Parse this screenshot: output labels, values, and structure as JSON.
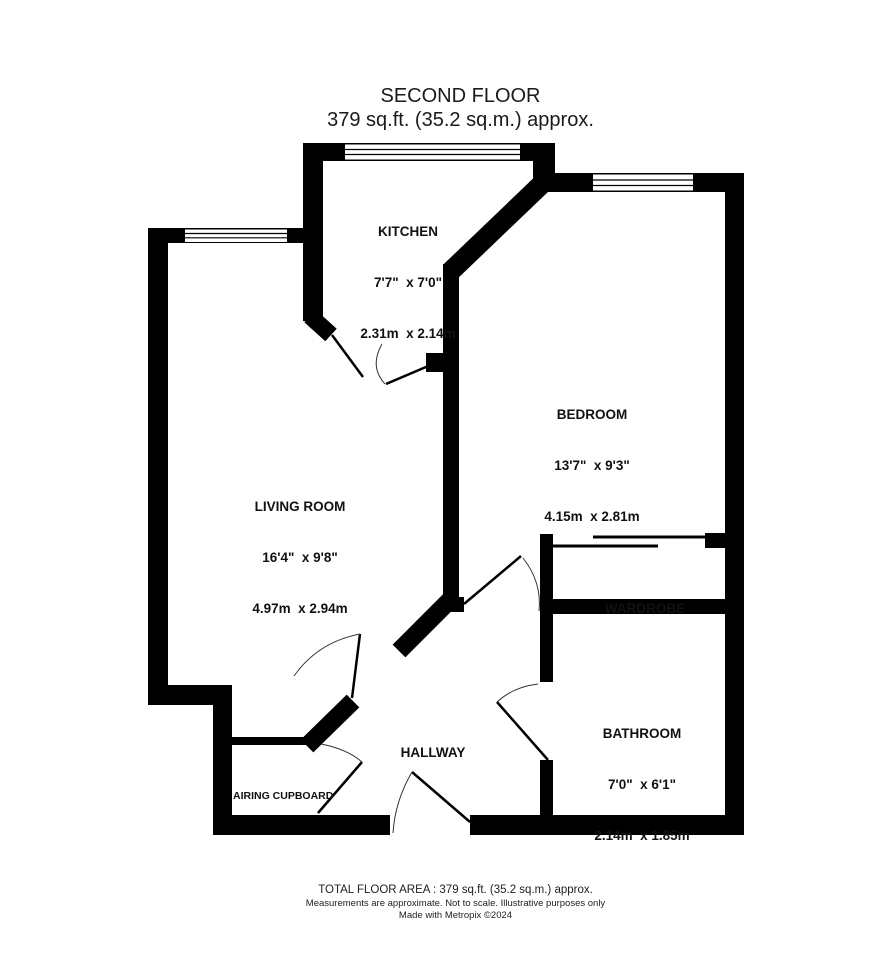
{
  "title": {
    "line1": "SECOND FLOOR",
    "line2": "379 sq.ft. (35.2 sq.m.) approx."
  },
  "rooms": [
    {
      "id": "kitchen",
      "name": "KITCHEN",
      "imperial": "7'7\"  x 7'0\"",
      "metric": "2.31m  x 2.14m"
    },
    {
      "id": "bedroom",
      "name": "BEDROOM",
      "imperial": "13'7\"  x 9'3\"",
      "metric": "4.15m  x 2.81m"
    },
    {
      "id": "living-room",
      "name": "LIVING ROOM",
      "imperial": "16'4\"  x 9'8\"",
      "metric": "4.97m  x 2.94m"
    },
    {
      "id": "wardrobe",
      "name": "WARDROBE"
    },
    {
      "id": "bathroom",
      "name": "BATHROOM",
      "imperial": "7'0\"  x 6'1\"",
      "metric": "2.14m  x 1.85m"
    },
    {
      "id": "hallway",
      "name": "HALLWAY"
    },
    {
      "id": "airing-cupboard",
      "name": "AIRING CUPBOARD"
    }
  ],
  "footer": {
    "line1": "TOTAL FLOOR AREA : 379 sq.ft. (35.2 sq.m.) approx.",
    "line2": "Measurements are approximate.  Not to scale.  Illustrative purposes only",
    "line3": "Made with Metropix ©2024"
  },
  "colors": {
    "walls": "#000000",
    "background": "#ffffff",
    "text": "#111111",
    "door_arc": "#333333"
  }
}
